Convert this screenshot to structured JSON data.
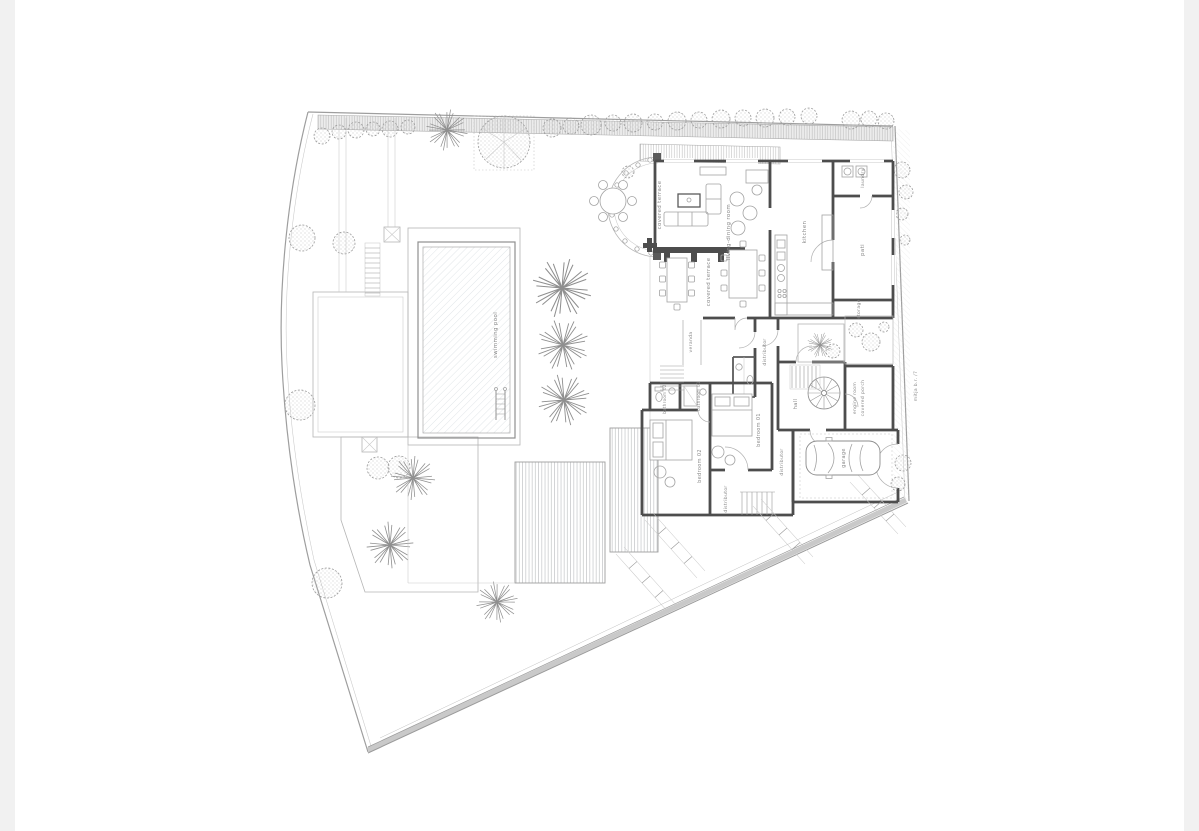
{
  "drawing": {
    "type": "architectural site plan - ground floor with garden and pool",
    "colors": {
      "paper": "#ffffff",
      "walls": "#4d4d4d",
      "boundary": "#9e9e9e",
      "hatch": "#c9c9c9",
      "text": "#8a8a8a",
      "edge_band": "#f1f1f1"
    },
    "labels": {
      "swimming_pool": "swimming pool",
      "covered_terrace_upper": "covered terrace",
      "living_dining_room": "living-dining room",
      "covered_terrace_lower": "covered terrace",
      "kitchen": "kitchen",
      "laundry": "laundry",
      "pati": "pati",
      "storage": "storage",
      "veranda": "veranda",
      "distributor_main": "distributor",
      "distributor_bedrooms": "distributor",
      "distributor_lower": "distributor",
      "hall": "hall",
      "engine_room": "engine room",
      "covered_porch": "covered porch",
      "garage": "garage",
      "bedroom_01": "bedroom 01",
      "bedroom_02": "bedroom 02",
      "bathroom_01": "bathroom 01",
      "bathroom_02": "bathroom 02",
      "boundary_note": "mitja b.r. /7"
    }
  }
}
